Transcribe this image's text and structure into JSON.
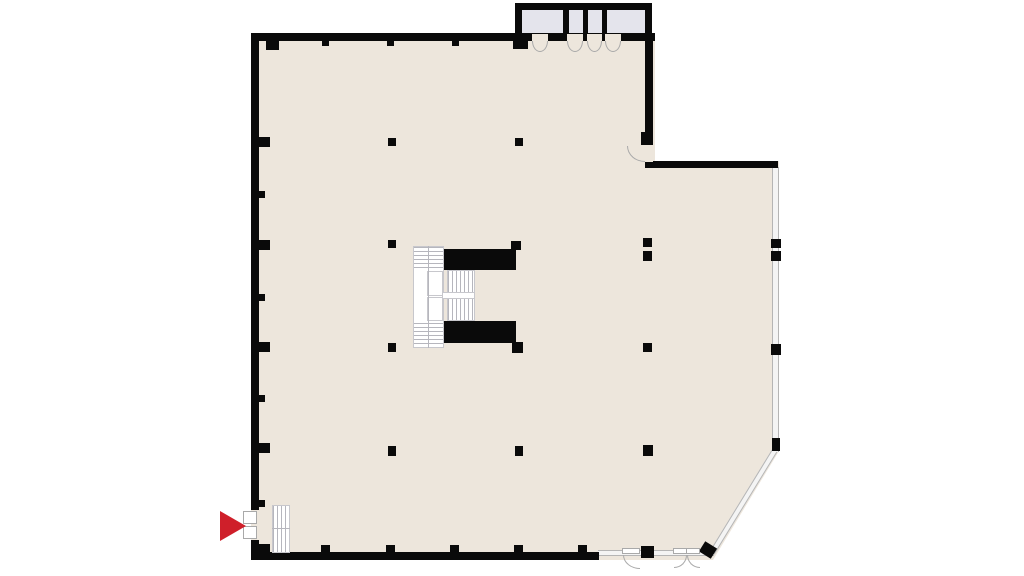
{
  "plan": {
    "description": "Open office floor plan: central stair and elevator core, regular column grid, four elevator/service compartments on the north wall, glazed east facade with chamfered south-east corner, south exit doors, and a red entrance arrow at the south-west door with a small straight stair inside."
  },
  "colors": {
    "background": "#ffffff",
    "floor": "#ede6dc",
    "wall": "#0a0a0a",
    "shaft_fill": "#e4e4ec",
    "glass_fill": "#f4f4f4",
    "glass_line": "#b5b5b5",
    "stair_line": "#b6b6bd",
    "stair_border": "#c7c7cc",
    "door_line": "#a9a9a9",
    "entrance_arrow": "#cf1f2a"
  },
  "geometry": {
    "walls": [
      {
        "x": 251,
        "y": 33,
        "w": 404,
        "h": 8,
        "name": "north-wall"
      },
      {
        "x": 251,
        "y": 33,
        "w": 8,
        "h": 527,
        "name": "west-wall"
      },
      {
        "x": 251,
        "y": 552,
        "w": 348,
        "h": 8,
        "name": "south-wall"
      },
      {
        "x": 645,
        "y": 33,
        "w": 8,
        "h": 112,
        "name": "east-wall-upper"
      },
      {
        "x": 645,
        "y": 161,
        "w": 133,
        "h": 7,
        "name": "east-wing-north-wall"
      },
      {
        "x": 515,
        "y": 3,
        "w": 137,
        "h": 7,
        "name": "elevator-box-north-wall"
      },
      {
        "x": 515,
        "y": 3,
        "w": 7,
        "h": 37,
        "name": "elevator-box-west-wall"
      },
      {
        "x": 645,
        "y": 3,
        "w": 7,
        "h": 37,
        "name": "elevator-box-east-wall"
      },
      {
        "x": 563,
        "y": 8,
        "w": 6,
        "h": 32,
        "name": "elevator-divider-wall"
      },
      {
        "x": 583,
        "y": 8,
        "w": 5,
        "h": 32,
        "name": "elevator-divider-wall"
      },
      {
        "x": 602,
        "y": 8,
        "w": 5,
        "h": 32,
        "name": "elevator-divider-wall"
      }
    ],
    "glass_walls": [
      {
        "x": 772,
        "y": 167,
        "w": 7,
        "h": 285,
        "cls": "glass-v",
        "name": "east-glass-wall"
      },
      {
        "x": 598,
        "y": 550,
        "w": 116,
        "h": 6,
        "cls": "glass-h",
        "name": "south-east-glass-wall"
      },
      {
        "x": 712,
        "y": 550,
        "w": 120,
        "h": 6,
        "cls": "glass-h",
        "rot": -58.5,
        "origin": "left center",
        "name": "chamfer-glass-wall"
      }
    ],
    "shafts": [
      {
        "x": 522,
        "y": 10,
        "w": 41,
        "h": 23,
        "name": "elevator-shaft"
      },
      {
        "x": 569,
        "y": 10,
        "w": 14,
        "h": 23,
        "name": "service-shaft"
      },
      {
        "x": 588,
        "y": 10,
        "w": 14,
        "h": 23,
        "name": "service-shaft"
      },
      {
        "x": 607,
        "y": 10,
        "w": 38,
        "h": 23,
        "name": "elevator-shaft"
      }
    ],
    "columns": [
      {
        "x": 388,
        "y": 138,
        "w": 8,
        "h": 8
      },
      {
        "x": 515,
        "y": 138,
        "w": 8,
        "h": 8
      },
      {
        "x": 641,
        "y": 132,
        "w": 12,
        "h": 13
      },
      {
        "x": 388,
        "y": 240,
        "w": 8,
        "h": 8
      },
      {
        "x": 511,
        "y": 241,
        "w": 10,
        "h": 9
      },
      {
        "x": 643,
        "y": 238,
        "w": 9,
        "h": 9
      },
      {
        "x": 643,
        "y": 251,
        "w": 9,
        "h": 10
      },
      {
        "x": 388,
        "y": 343,
        "w": 8,
        "h": 9
      },
      {
        "x": 512,
        "y": 342,
        "w": 11,
        "h": 11
      },
      {
        "x": 643,
        "y": 343,
        "w": 9,
        "h": 9
      },
      {
        "x": 388,
        "y": 446,
        "w": 8,
        "h": 10
      },
      {
        "x": 515,
        "y": 446,
        "w": 8,
        "h": 10
      },
      {
        "x": 643,
        "y": 445,
        "w": 10,
        "h": 11
      }
    ],
    "wall_blocks": [
      {
        "x": 771,
        "y": 239,
        "w": 10,
        "h": 9
      },
      {
        "x": 771,
        "y": 251,
        "w": 10,
        "h": 10
      },
      {
        "x": 771,
        "y": 344,
        "w": 10,
        "h": 11
      },
      {
        "x": 772,
        "y": 438,
        "w": 8,
        "h": 13
      },
      {
        "x": 641,
        "y": 546,
        "w": 13,
        "h": 12
      },
      {
        "x": 702,
        "y": 543,
        "w": 12,
        "h": 14,
        "rot": -58
      }
    ],
    "pilasters": [
      {
        "x": 258,
        "y": 137,
        "w": 12,
        "h": 10
      },
      {
        "x": 258,
        "y": 240,
        "w": 12,
        "h": 10
      },
      {
        "x": 258,
        "y": 342,
        "w": 12,
        "h": 10
      },
      {
        "x": 258,
        "y": 443,
        "w": 12,
        "h": 10
      },
      {
        "x": 258,
        "y": 191,
        "w": 7,
        "h": 7
      },
      {
        "x": 258,
        "y": 294,
        "w": 7,
        "h": 7
      },
      {
        "x": 258,
        "y": 395,
        "w": 7,
        "h": 7
      },
      {
        "x": 258,
        "y": 500,
        "w": 7,
        "h": 7
      },
      {
        "x": 266,
        "y": 40,
        "w": 13,
        "h": 10
      },
      {
        "x": 322,
        "y": 40,
        "w": 7,
        "h": 6
      },
      {
        "x": 387,
        "y": 40,
        "w": 7,
        "h": 6
      },
      {
        "x": 452,
        "y": 40,
        "w": 7,
        "h": 6
      },
      {
        "x": 513,
        "y": 40,
        "w": 15,
        "h": 9
      },
      {
        "x": 259,
        "y": 544,
        "w": 11,
        "h": 9
      },
      {
        "x": 321,
        "y": 545,
        "w": 9,
        "h": 8
      },
      {
        "x": 386,
        "y": 545,
        "w": 9,
        "h": 8
      },
      {
        "x": 450,
        "y": 545,
        "w": 9,
        "h": 8
      },
      {
        "x": 514,
        "y": 545,
        "w": 9,
        "h": 8
      },
      {
        "x": 578,
        "y": 545,
        "w": 9,
        "h": 8
      }
    ],
    "core": [
      {
        "x": 413,
        "y": 246,
        "w": 31,
        "h": 102,
        "cls": "stair-h",
        "name": "core-stair-west"
      },
      {
        "x": 414,
        "y": 270,
        "w": 29,
        "h": 52,
        "cls": "plain",
        "name": "core-landing"
      },
      {
        "x": 427,
        "y": 271,
        "w": 16,
        "h": 25,
        "cls": "rail",
        "name": "core-landing-rail"
      },
      {
        "x": 427,
        "y": 297,
        "w": 16,
        "h": 24,
        "cls": "rail",
        "name": "core-landing-rail"
      },
      {
        "x": 428,
        "y": 246,
        "w": 1,
        "h": 102,
        "cls": "divider",
        "name": "core-stair-divider"
      },
      {
        "x": 447,
        "y": 270,
        "w": 28,
        "h": 24,
        "cls": "stair-v",
        "name": "core-stair-mid-upper"
      },
      {
        "x": 447,
        "y": 298,
        "w": 28,
        "h": 23,
        "cls": "stair-v",
        "name": "core-stair-mid-lower"
      },
      {
        "x": 442,
        "y": 292,
        "w": 33,
        "h": 7,
        "cls": "rail",
        "name": "core-mid-landing"
      },
      {
        "x": 444,
        "y": 249,
        "w": 72,
        "h": 21,
        "cls": "shaft-black",
        "name": "core-shaft-north"
      },
      {
        "x": 444,
        "y": 321,
        "w": 72,
        "h": 22,
        "cls": "shaft-black",
        "name": "core-shaft-south"
      }
    ],
    "doors": [
      {
        "x": 532,
        "y": 34,
        "w": 16,
        "h": 7,
        "cls": "gap-floor",
        "name": "elevator-door-opening"
      },
      {
        "x": 567,
        "y": 34,
        "w": 16,
        "h": 7,
        "cls": "gap-floor",
        "name": "elevator-door-opening"
      },
      {
        "x": 587,
        "y": 34,
        "w": 15,
        "h": 7,
        "cls": "gap-floor",
        "name": "elevator-door-opening"
      },
      {
        "x": 605,
        "y": 34,
        "w": 16,
        "h": 7,
        "cls": "gap-floor",
        "name": "elevator-door-opening"
      },
      {
        "x": 532,
        "y": 41,
        "w": 16,
        "h": 11,
        "cls": "arc-semi-down",
        "name": "elevator-door-swing"
      },
      {
        "x": 567,
        "y": 41,
        "w": 16,
        "h": 11,
        "cls": "arc-semi-down",
        "name": "elevator-door-swing"
      },
      {
        "x": 587,
        "y": 41,
        "w": 15,
        "h": 11,
        "cls": "arc-semi-down",
        "name": "elevator-door-swing"
      },
      {
        "x": 605,
        "y": 41,
        "w": 16,
        "h": 11,
        "cls": "arc-semi-down",
        "name": "elevator-door-swing"
      },
      {
        "x": 645,
        "y": 145,
        "w": 8,
        "h": 17,
        "cls": "gap-floor",
        "name": "east-door-opening"
      },
      {
        "x": 627,
        "y": 146,
        "w": 18,
        "h": 16,
        "cls": "arc-q-bl",
        "name": "east-door-swing"
      },
      {
        "x": 251,
        "y": 510,
        "w": 8,
        "h": 30,
        "cls": "gap-floor",
        "name": "entrance-door-opening"
      },
      {
        "x": 243,
        "y": 511,
        "w": 14,
        "h": 13,
        "cls": "leaf",
        "name": "entrance-door-leaf"
      },
      {
        "x": 243,
        "y": 526,
        "w": 14,
        "h": 13,
        "cls": "leaf",
        "name": "entrance-door-leaf"
      },
      {
        "x": 622,
        "y": 548,
        "w": 18,
        "h": 6,
        "cls": "leaf",
        "name": "south-door-leaf"
      },
      {
        "x": 623,
        "y": 555,
        "w": 17,
        "h": 14,
        "cls": "arc-q-bl",
        "name": "south-door-swing"
      },
      {
        "x": 673,
        "y": 548,
        "w": 14,
        "h": 6,
        "cls": "leaf",
        "name": "south-double-door-leaf"
      },
      {
        "x": 686,
        "y": 548,
        "w": 14,
        "h": 6,
        "cls": "leaf",
        "name": "south-double-door-leaf"
      },
      {
        "x": 674,
        "y": 555,
        "w": 13,
        "h": 13,
        "cls": "arc-q-br",
        "name": "south-double-door-swing"
      },
      {
        "x": 687,
        "y": 555,
        "w": 13,
        "h": 13,
        "cls": "arc-q-bl",
        "name": "south-double-door-swing"
      }
    ],
    "entrance": [
      {
        "x": 272,
        "y": 505,
        "w": 18,
        "h": 48,
        "cls": "stair-v",
        "name": "entrance-stair"
      },
      {
        "x": 272,
        "y": 528,
        "w": 18,
        "h": 1,
        "cls": "divider",
        "name": "entrance-stair-landing"
      },
      {
        "x": 220,
        "y": 511,
        "w": 26,
        "h": 30,
        "cls": "arrow-right",
        "name": "entrance-arrow-icon"
      }
    ]
  }
}
